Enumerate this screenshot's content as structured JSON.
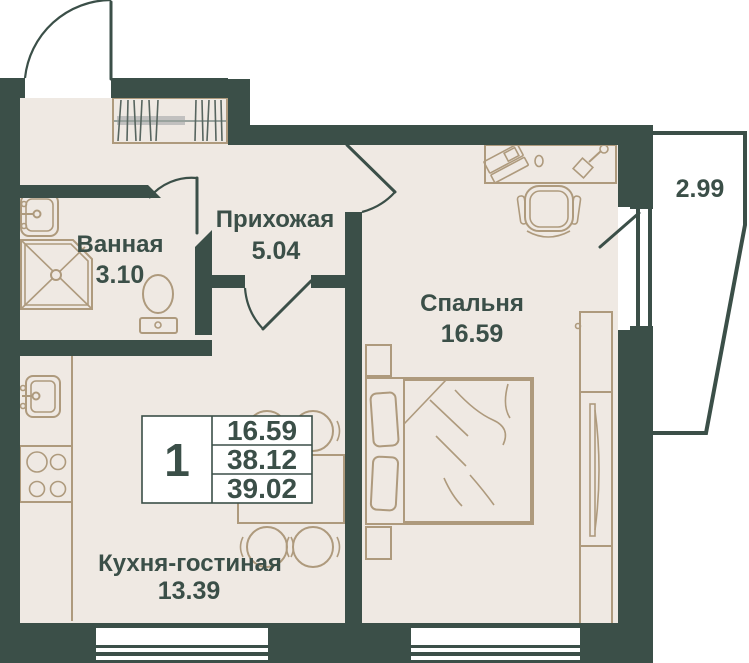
{
  "plan": {
    "rooms": [
      {
        "name": "Ванная",
        "area": "3.10"
      },
      {
        "name": "Прихожая",
        "area": "5.04"
      },
      {
        "name": "Спальня",
        "area": "16.59"
      },
      {
        "name": "Кухня-гостиная",
        "area": "13.39"
      }
    ],
    "balcony": {
      "area": "2.99"
    },
    "summary": {
      "rooms_count": "1",
      "living_area": "16.59",
      "area_no_balcony": "38.12",
      "total_area": "39.02"
    },
    "colors": {
      "wall": "#3b4f48",
      "floor": "#efe9e3",
      "furniture_outline": "#ae9a7d",
      "text": "#3b4f48",
      "outside": "#ffffff"
    }
  }
}
